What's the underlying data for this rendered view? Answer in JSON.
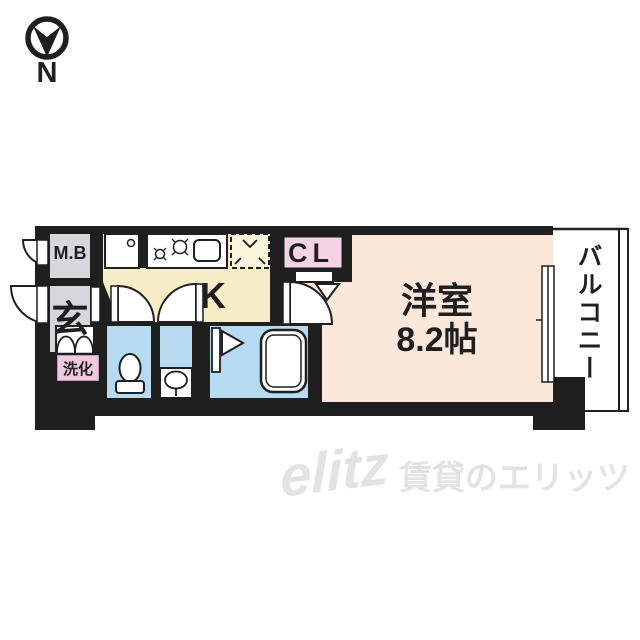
{
  "compass": {
    "north_label": "N"
  },
  "floorplan": {
    "rooms": {
      "meter_box": {
        "label": "M.B"
      },
      "entrance": {
        "label": "玄"
      },
      "vanity": {
        "label": "洗化"
      },
      "kitchen": {
        "label": "K"
      },
      "closet": {
        "label": "CL"
      },
      "western_room": {
        "name": "洋室",
        "size": "8.2帖"
      },
      "balcony": {
        "label": "バルコニー"
      }
    },
    "icons": {
      "compass": "north-arrow-in-circle",
      "stove": "two-burner-stove",
      "sink": "kitchen-sink",
      "refrigerator_space": "dashed-refrigerator-box",
      "washing_machine": "washing-machine-pan",
      "shoe_cabinet": "double-arch-cabinet",
      "toilet": "toilet-bowl",
      "washbasin": "oval-basin",
      "bathtub": "rounded-bathtub",
      "doors": "quarter-circle-swing-arcs",
      "closet_door": "folding-door-triangle",
      "window": "double-line-sliding-window"
    },
    "colors": {
      "wall": "#1f1f1f",
      "utility_gray": "#d7d6db",
      "kitchen_cream": "#f6ecc6",
      "fridge_cream": "#fcf5dd",
      "closet_pink": "#f4d3e4",
      "vanity_pink": "#f0c8dc",
      "wet_area_blue": "#b6dbf0",
      "room_peach": "#fbe8db",
      "watermark_gray": "#e3e3e3"
    }
  },
  "watermark": {
    "logo": "elitz",
    "text": "賃貸のエリッツ"
  }
}
